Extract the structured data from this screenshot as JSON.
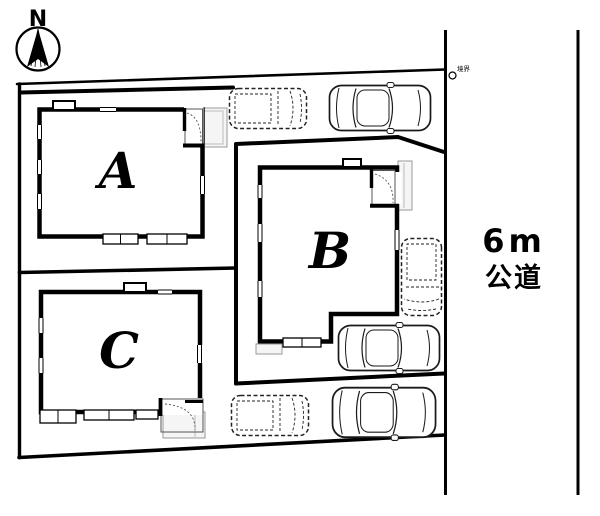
{
  "compass": {
    "label": "N"
  },
  "road": {
    "width_label": "6m",
    "name_label": "公道"
  },
  "buildings": [
    {
      "id": "a",
      "label": "A"
    },
    {
      "id": "b",
      "label": "B"
    },
    {
      "id": "c",
      "label": "C"
    }
  ],
  "marker": {
    "label": "境界"
  },
  "vehicles": [
    {
      "id": "car-dashed-top",
      "style": "dashed"
    },
    {
      "id": "car-solid-top",
      "style": "solid"
    },
    {
      "id": "car-dashed-east",
      "style": "dashed"
    },
    {
      "id": "car-solid-middle",
      "style": "solid"
    },
    {
      "id": "car-dashed-bottom",
      "style": "dashed"
    },
    {
      "id": "car-solid-bottom",
      "style": "solid"
    }
  ],
  "colors": {
    "ink": "#000000",
    "background": "#ffffff",
    "porch_fill": "#f5f5f5"
  }
}
